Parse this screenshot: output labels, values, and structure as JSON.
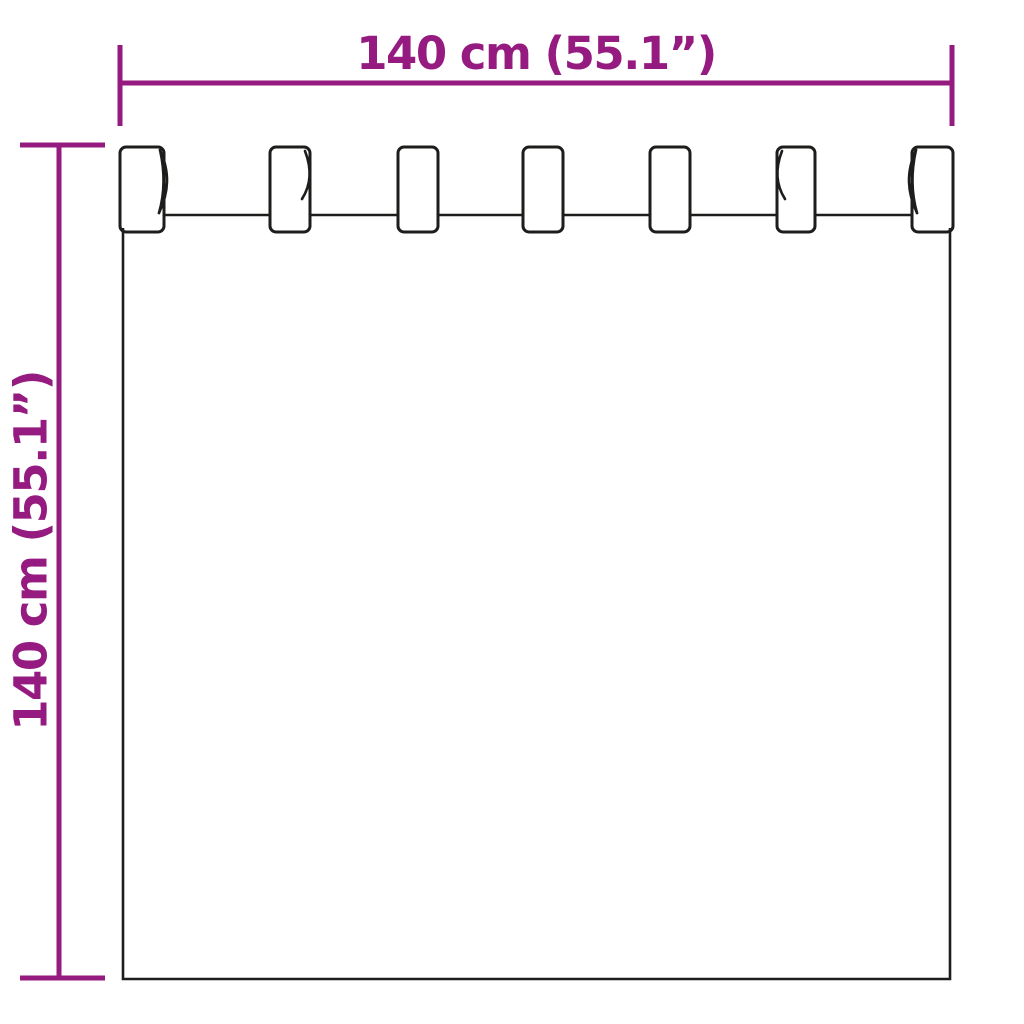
{
  "diagram": {
    "type": "product-dimension-diagram",
    "subject": "tab-top-curtain",
    "accent_color": "#951b81",
    "outline_color": "#1d1d1b",
    "width_label": "140 cm (55.1”)",
    "height_label": "140 cm (55.1”)",
    "tab_count": 7,
    "tab_top_y": 147,
    "tab_height": 85,
    "tabs": [
      {
        "x": 120,
        "w": 44,
        "fold": "right-loop"
      },
      {
        "x": 270,
        "w": 40,
        "fold": "right"
      },
      {
        "x": 398,
        "w": 40,
        "fold": "none"
      },
      {
        "x": 523,
        "w": 40,
        "fold": "none"
      },
      {
        "x": 650,
        "w": 40,
        "fold": "none"
      },
      {
        "x": 777,
        "w": 38,
        "fold": "left"
      },
      {
        "x": 912,
        "w": 41,
        "fold": "left-loop"
      }
    ]
  }
}
